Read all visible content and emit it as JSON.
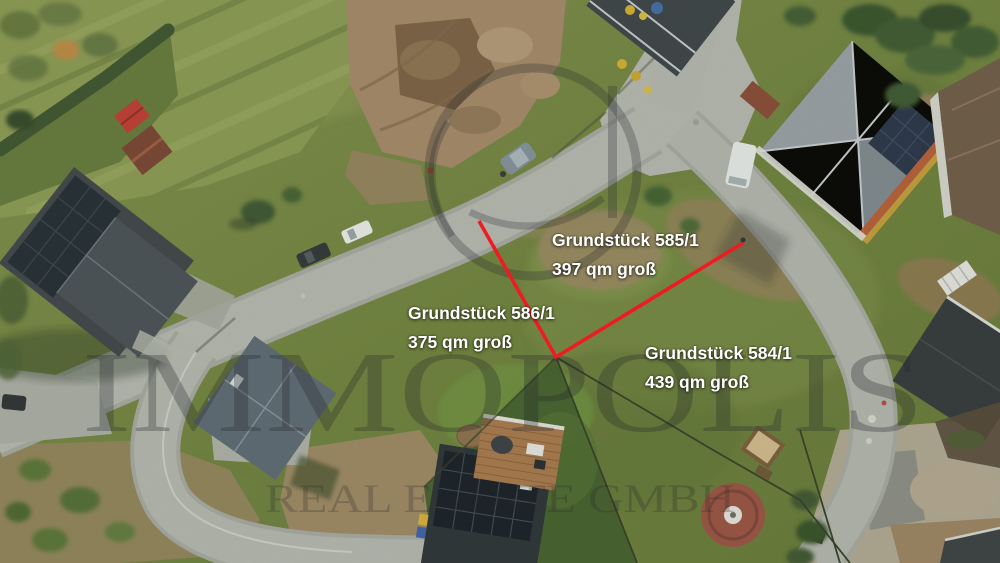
{
  "meta": {
    "type": "aerial-drone-photo",
    "language": "de",
    "description": "Luftaufnahme eines Neubaugebiets mit drei markierten Baugrundstuecken"
  },
  "parcels": [
    {
      "id": "585-1",
      "name": "Grundstück 585/1",
      "size": "397 qm groß"
    },
    {
      "id": "586-1",
      "name": "Grundstück 586/1",
      "size": "375 qm groß"
    },
    {
      "id": "584-1",
      "name": "Grundstück 584/1",
      "size": "439 qm groß"
    }
  ],
  "watermark": {
    "brand": "IMMOPOLIS",
    "subline": "REAL ESTATE GMBH"
  },
  "colors": {
    "boundary": "#ee1b22",
    "label_text": "#ffffff",
    "watermark": "#2b2d31",
    "road": "#b4b7b1",
    "grass": "#74853f",
    "dirt": "#a3886a"
  }
}
